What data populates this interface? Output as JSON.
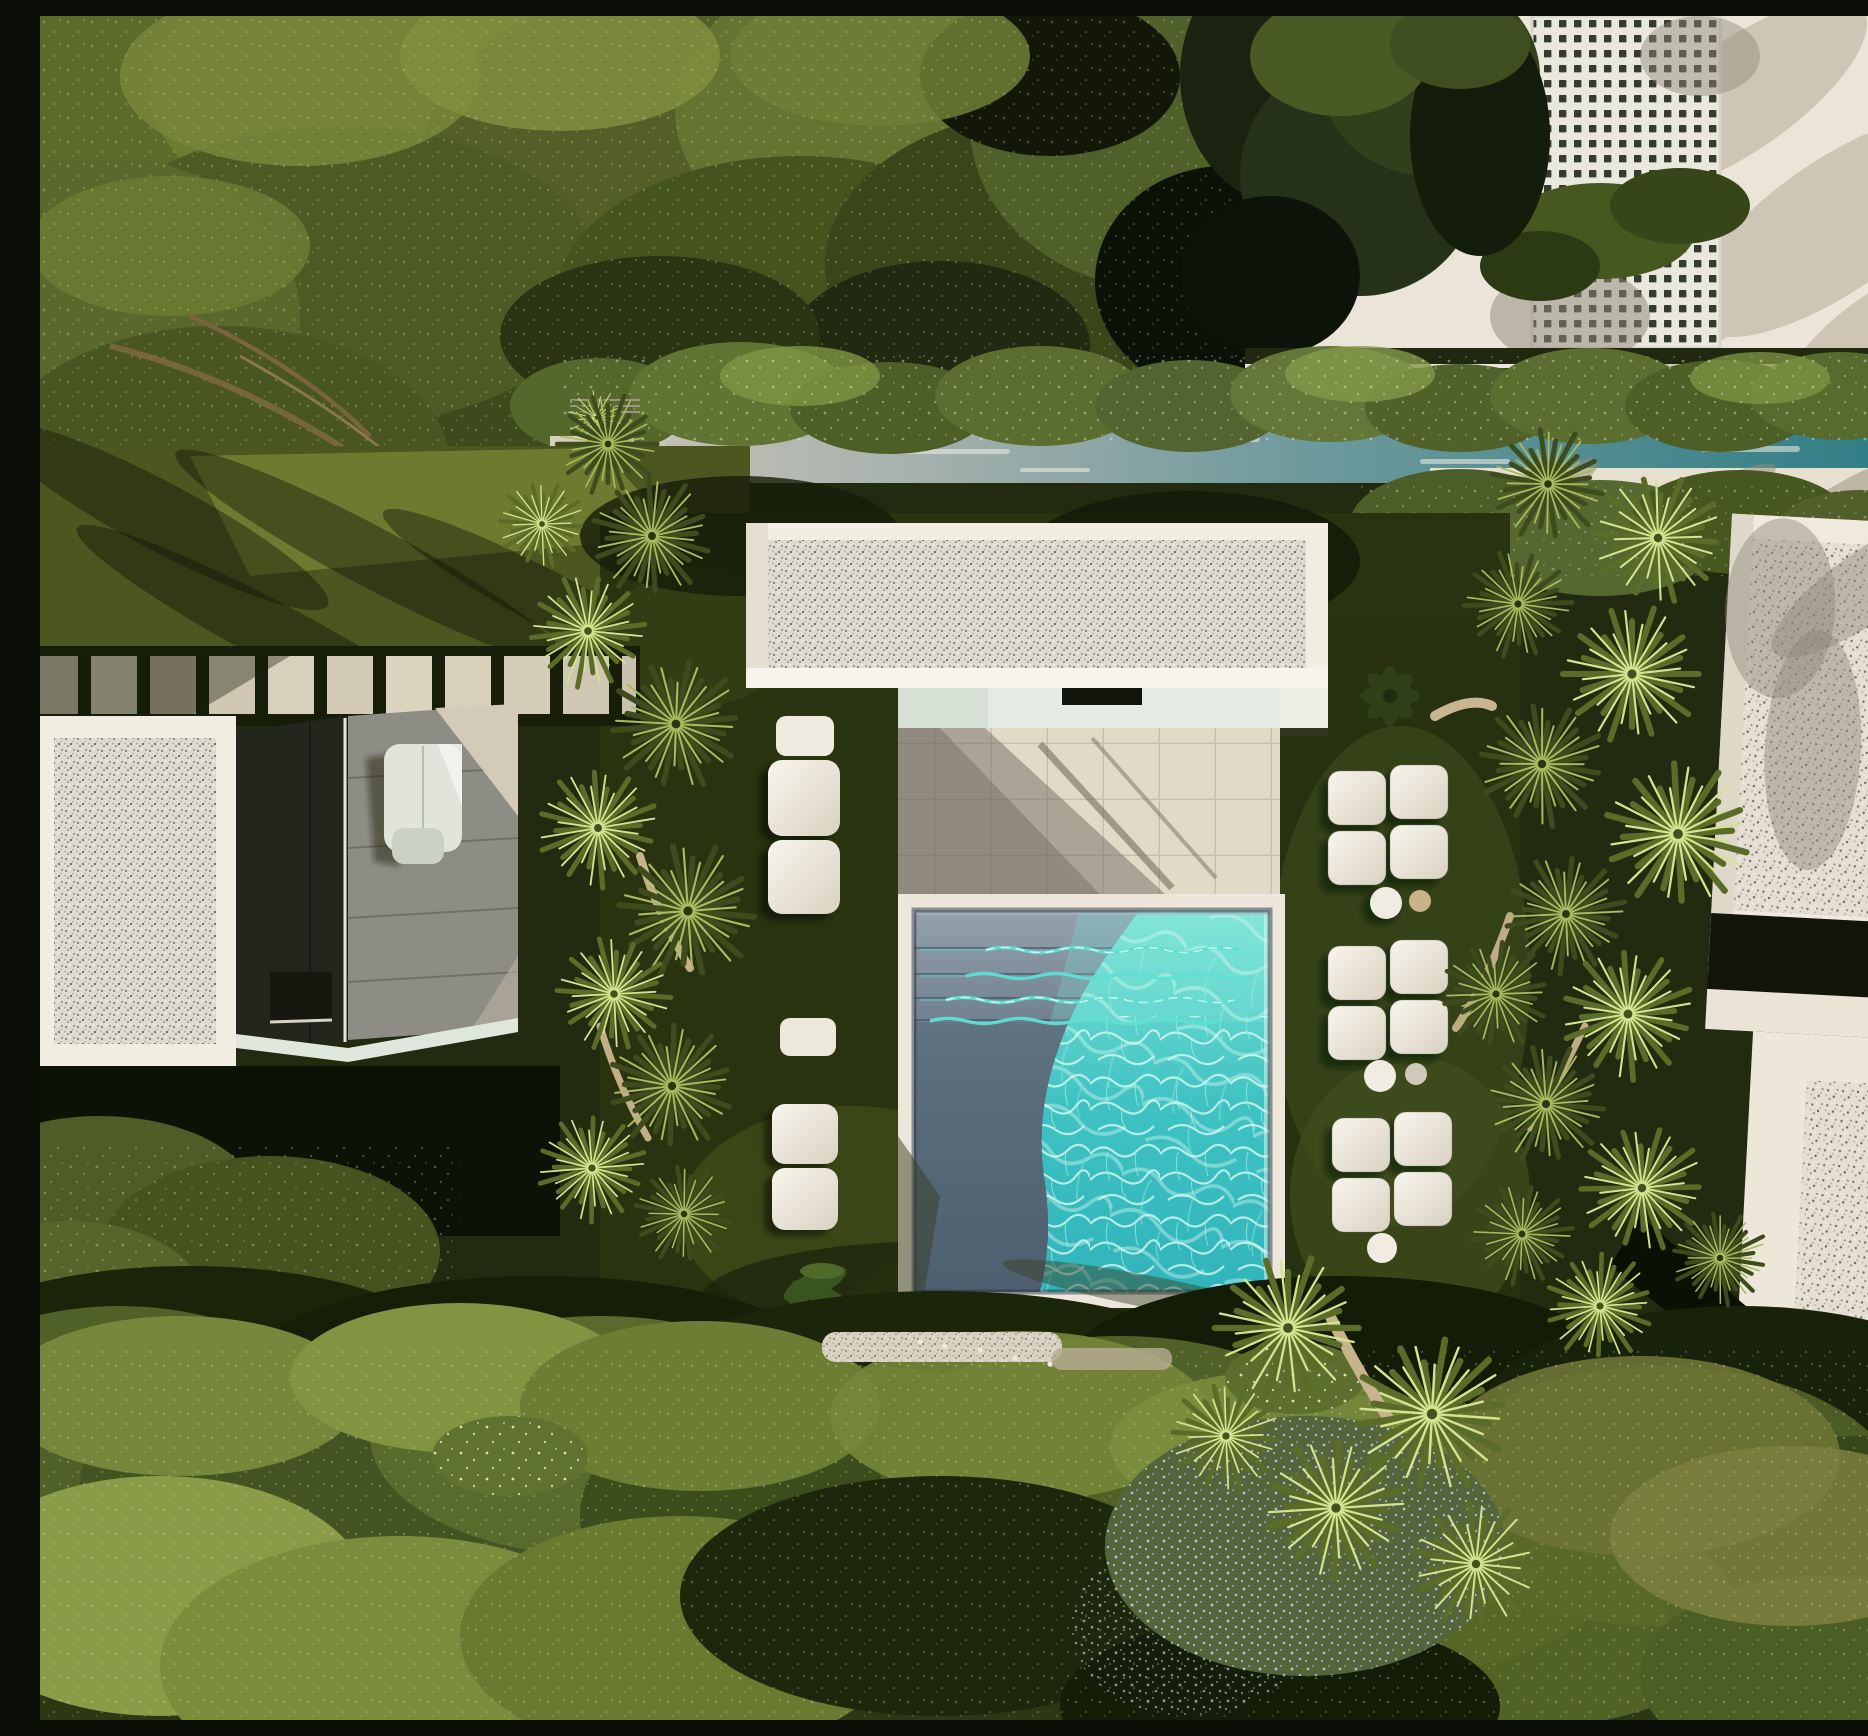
{
  "scene": {
    "title": "Aerial drone view of a modern white villa complex with a square swimming pool, gravel flat roofs, fan palms and dense gardens",
    "time_of_day": "late afternoon, low sun from the upper right casting long diagonal shadows",
    "view": "top-down aerial"
  },
  "palette": {
    "structure_white": "#eae5d8",
    "structure_bright_white": "#f2eee2",
    "fascia_white": "#f7f4eb",
    "mint_wall": "#e3ebe2",
    "patio_tile": "#cfc8b8",
    "patio_lit": "#e2dac6",
    "patio_shadow": "#8f8a7d",
    "pool_coping": "#ece7da",
    "pool_shadow_water": "#4e6070",
    "pool_sunlit_water": "#2fb7bd",
    "pool_caustic": "#dafcf2",
    "teal_channel": "#2e7d85",
    "lawn_dark": "#29330f",
    "shrub_base": "#2c3713",
    "canopy_green": "#5c6b2a",
    "hedge_green": "#5b6e2f",
    "cushion_white": "#f0ece2",
    "terrace_gray": "#8e8d85",
    "charcoal": "#23261c",
    "paver_stone": "#d2cab5",
    "gravel_roof": "#dedacf",
    "palm_dark": "#3e4b1d",
    "palm_light": "#a9ba5f",
    "trunk_beige": "#c7b38c"
  },
  "inventory": {
    "swimming_pool": 1,
    "water_channel": 1,
    "pavilions": 3,
    "lattice_panel": 1,
    "lounger_cushions_right": 6,
    "lounger_cushions_left": 5,
    "side_tables": 4,
    "stepping_stones": 11,
    "stair_treads": 5,
    "palm_heads": 33
  },
  "icons": {
    "palm_icon": "radial spiky fan-palm burst",
    "caustic_icon": "turquoise water caustic web"
  }
}
